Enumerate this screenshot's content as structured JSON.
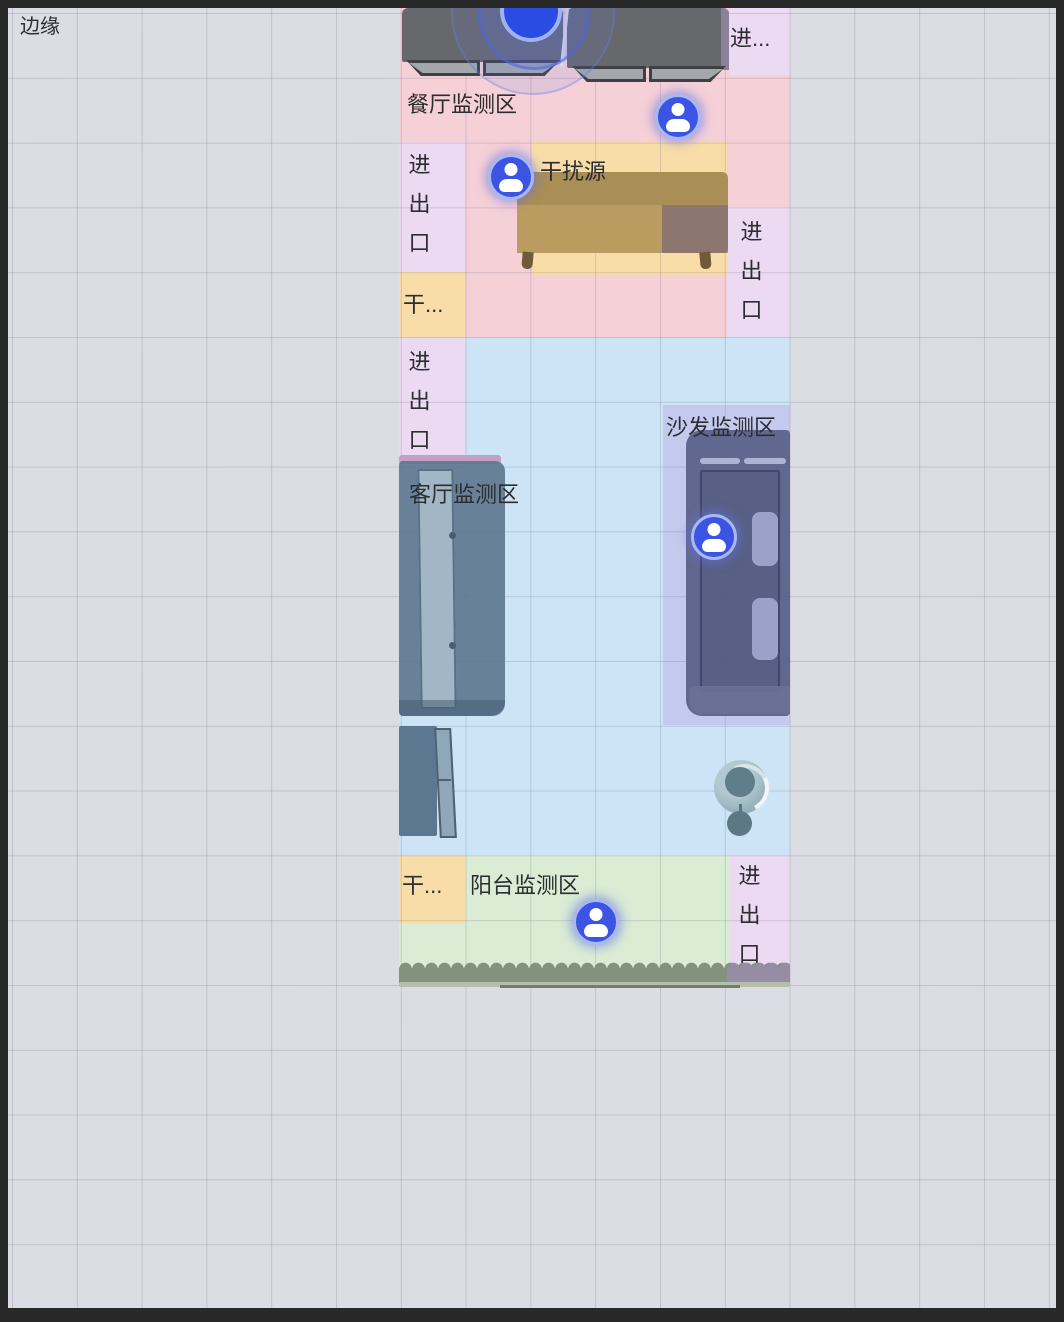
{
  "canvas": {
    "bg": "#dcdce4",
    "grid_line": "#c6c6d0",
    "edge_label": "边缘"
  },
  "zones": {
    "dining": {
      "label": "餐厅监测区",
      "color": "#f5d0d7"
    },
    "living": {
      "label": "客厅监测区",
      "color": "#cce4f5"
    },
    "sofa": {
      "label": "沙发监测区",
      "color": "#c4caee"
    },
    "balcony": {
      "label": "阳台监测区",
      "color": "#daecd4"
    },
    "entrance": {
      "label": "进出口",
      "label_truncated": "进...",
      "color": "#ebdaf2"
    },
    "interference": {
      "label": "干扰源",
      "label_truncated": "干...",
      "color": "#f8dda9"
    }
  },
  "markers": {
    "person_count": 4,
    "person_color": "#3b54e3",
    "radar_color": "#2a4ce2"
  }
}
